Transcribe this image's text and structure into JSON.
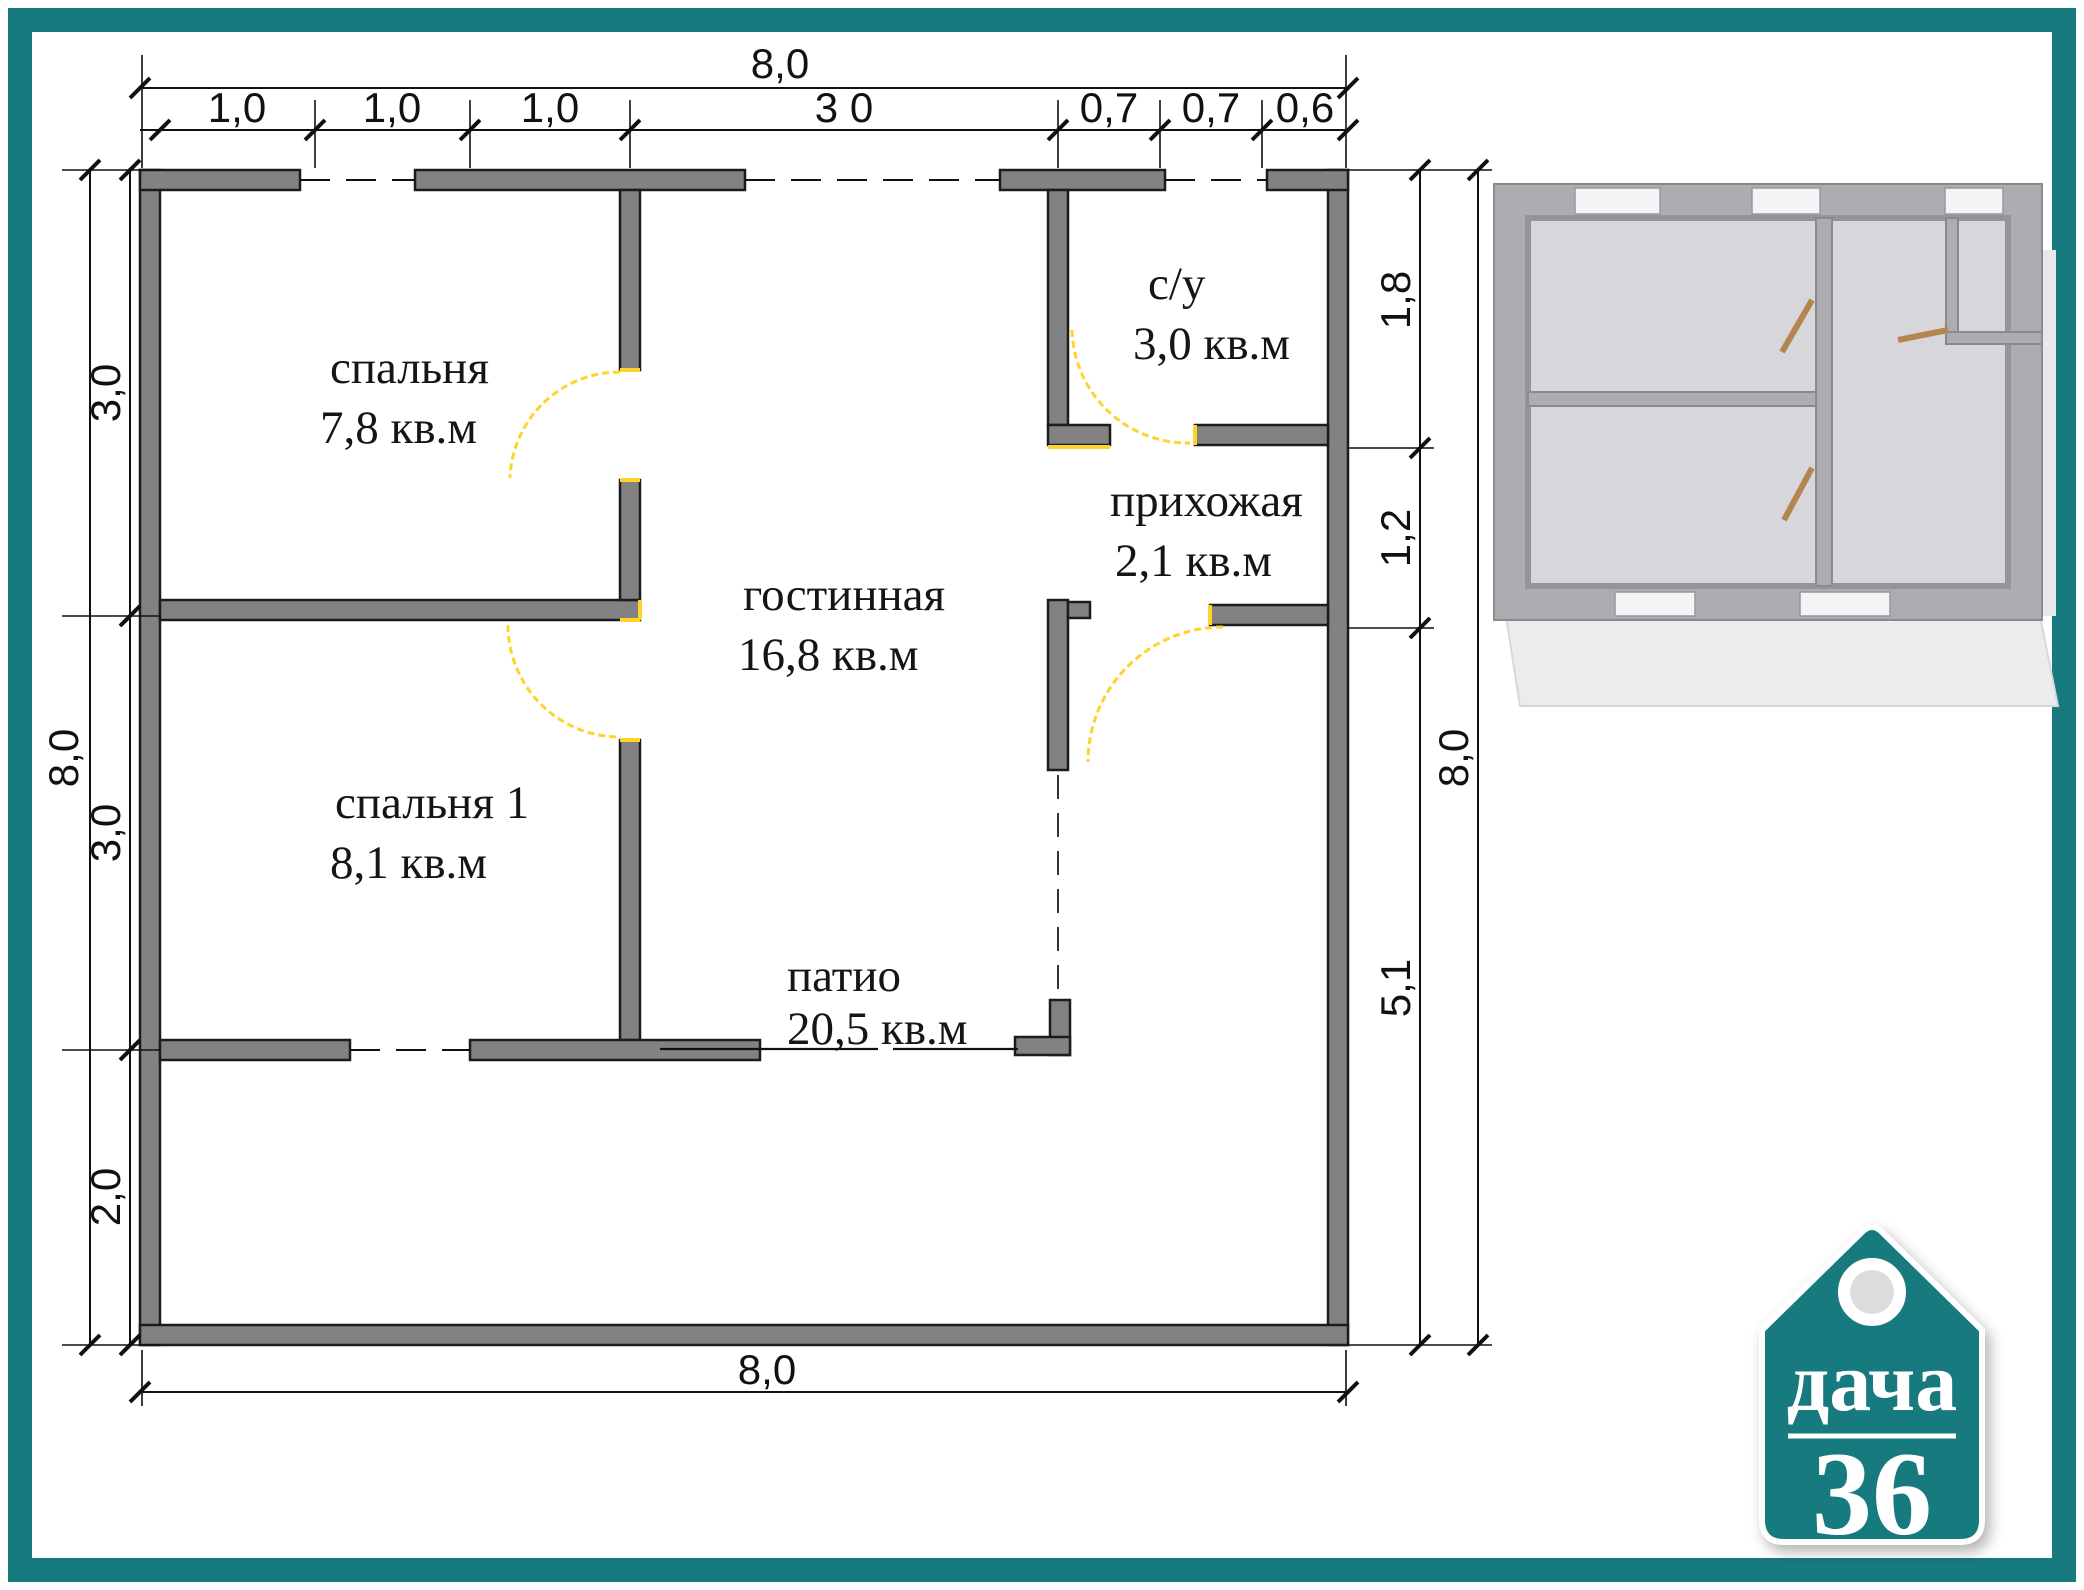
{
  "colors": {
    "frame_teal": "#177a7e",
    "wall_gray": "#828282",
    "door_yellow": "#ffd42a"
  },
  "rooms": [
    {
      "name": "спальня",
      "area": "7,8 кв.м"
    },
    {
      "name": "с/у",
      "area": "3,0 кв.м"
    },
    {
      "name": "прихожая",
      "area": "2,1 кв.м"
    },
    {
      "name": "гостинная",
      "area": "16,8 кв.м"
    },
    {
      "name": "спальня 1",
      "area": "8,1 кв.м"
    },
    {
      "name": "патио",
      "area": "20,5 кв.м"
    }
  ],
  "dims": {
    "top_total": "8,0",
    "top_segments": [
      "1,0",
      "1,0",
      "1,0",
      "3 0",
      "0,7",
      "0,7",
      "0,6"
    ],
    "left_total": "8,0",
    "left_segments": [
      "3,0",
      "3,0",
      "2,0"
    ],
    "right_total": "8,0",
    "right_segments": [
      "1,8",
      "1,2",
      "5,1"
    ],
    "bottom_total": "8,0"
  },
  "logo": {
    "word": "дача",
    "number": "36"
  }
}
